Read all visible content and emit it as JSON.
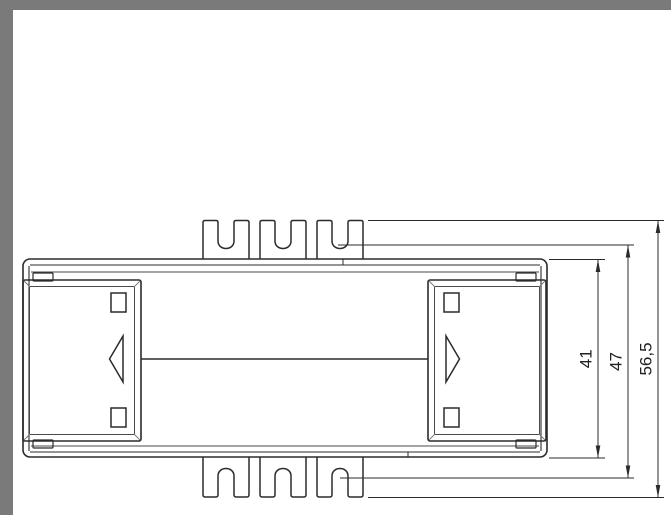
{
  "page": {
    "background": "#ffffff"
  },
  "frame": {
    "color": "#7a7a7a"
  },
  "drawing": {
    "line_color": "#2b2b2b",
    "dimensions": [
      {
        "id": "dim-41",
        "value": "41"
      },
      {
        "id": "dim-47",
        "value": "47"
      },
      {
        "id": "dim-56-5",
        "value": "56,5"
      }
    ]
  }
}
